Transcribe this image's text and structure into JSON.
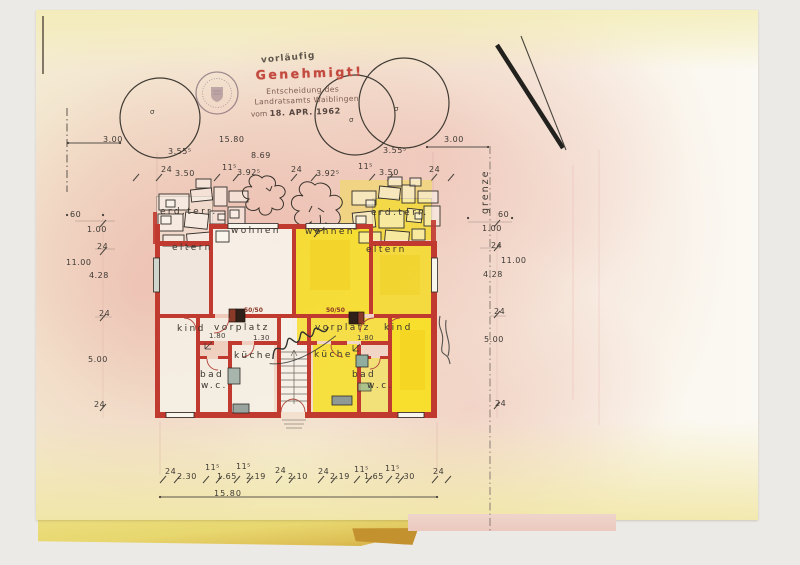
{
  "stamp": {
    "pre": "vorläufig",
    "title": "Genehmigt!",
    "line2": "Entscheidung des",
    "line3": "Landratsamts Waiblingen",
    "line4_prefix": "vom",
    "date": "18. APR. 1962"
  },
  "boundary": {
    "grenze": "grenze"
  },
  "trees": {
    "marks": [
      {
        "text": "σ",
        "x": 150,
        "y": 109
      },
      {
        "text": "σ",
        "x": 349,
        "y": 117
      },
      {
        "text": "σ",
        "x": 394,
        "y": 106
      }
    ]
  },
  "dims": {
    "row_overall": [
      {
        "text": "3.00",
        "x": 103,
        "y": 136
      },
      {
        "text": "15.80",
        "x": 219,
        "y": 136
      },
      {
        "text": "3.00",
        "x": 444,
        "y": 136
      }
    ],
    "row_house": [
      {
        "text": "3.55⁵",
        "x": 168,
        "y": 148
      },
      {
        "text": "8.69",
        "x": 251,
        "y": 152
      },
      {
        "text": "3.55⁵",
        "x": 383,
        "y": 147
      }
    ],
    "row_rooms_top": [
      {
        "text": "24",
        "x": 161,
        "y": 166
      },
      {
        "text": "3.50",
        "x": 175,
        "y": 170
      },
      {
        "text": "11⁵",
        "x": 222,
        "y": 164
      },
      {
        "text": "3.92⁵",
        "x": 237,
        "y": 169
      },
      {
        "text": "24",
        "x": 291,
        "y": 166
      },
      {
        "text": "3.92⁵",
        "x": 316,
        "y": 170
      },
      {
        "text": "11⁵",
        "x": 358,
        "y": 163
      },
      {
        "text": "3.50",
        "x": 379,
        "y": 169
      },
      {
        "text": "24",
        "x": 429,
        "y": 166
      }
    ],
    "col_left": [
      {
        "text": "60",
        "x": 70,
        "y": 211
      },
      {
        "text": "1.00",
        "x": 87,
        "y": 226
      },
      {
        "text": "24",
        "x": 97,
        "y": 243
      },
      {
        "text": "11.00",
        "x": 66,
        "y": 259
      },
      {
        "text": "4.28",
        "x": 89,
        "y": 272
      },
      {
        "text": "24",
        "x": 99,
        "y": 310
      },
      {
        "text": "5.00",
        "x": 88,
        "y": 356
      },
      {
        "text": "24",
        "x": 94,
        "y": 401
      }
    ],
    "col_right": [
      {
        "text": "60",
        "x": 498,
        "y": 211
      },
      {
        "text": "1.00",
        "x": 482,
        "y": 225
      },
      {
        "text": "24",
        "x": 491,
        "y": 242
      },
      {
        "text": "11.00",
        "x": 501,
        "y": 257
      },
      {
        "text": "4.28",
        "x": 483,
        "y": 271
      },
      {
        "text": "24",
        "x": 494,
        "y": 308
      },
      {
        "text": "5.00",
        "x": 484,
        "y": 336
      },
      {
        "text": "24",
        "x": 495,
        "y": 400
      }
    ],
    "row_bottom": [
      {
        "text": "24",
        "x": 165,
        "y": 468
      },
      {
        "text": "2.30",
        "x": 177,
        "y": 473
      },
      {
        "text": "11⁵",
        "x": 205,
        "y": 464
      },
      {
        "text": "1.65",
        "x": 217,
        "y": 473
      },
      {
        "text": "11⁵",
        "x": 236,
        "y": 463
      },
      {
        "text": "2.19",
        "x": 246,
        "y": 473
      },
      {
        "text": "24",
        "x": 275,
        "y": 467
      },
      {
        "text": "2.10",
        "x": 288,
        "y": 473
      },
      {
        "text": "24",
        "x": 318,
        "y": 468
      },
      {
        "text": "2.19",
        "x": 330,
        "y": 473
      },
      {
        "text": "11⁵",
        "x": 354,
        "y": 466
      },
      {
        "text": "1.65",
        "x": 364,
        "y": 473
      },
      {
        "text": "11⁵",
        "x": 385,
        "y": 465
      },
      {
        "text": "2.30",
        "x": 395,
        "y": 473
      },
      {
        "text": "24",
        "x": 433,
        "y": 468
      }
    ],
    "bottom_total": {
      "text": "15.80"
    }
  },
  "rooms": [
    {
      "text": "erd.terr.",
      "x": 160,
      "y": 208
    },
    {
      "text": "wohnen",
      "x": 231,
      "y": 227
    },
    {
      "text": "eltern",
      "x": 172,
      "y": 244
    },
    {
      "text": "wohnen",
      "x": 305,
      "y": 228
    },
    {
      "text": "erd.terr.",
      "x": 371,
      "y": 209
    },
    {
      "text": "eltern",
      "x": 366,
      "y": 246
    },
    {
      "text": "kind",
      "x": 177,
      "y": 325
    },
    {
      "text": "vorplatz",
      "x": 214,
      "y": 324
    },
    {
      "text": "küche",
      "x": 234,
      "y": 352
    },
    {
      "text": "bad",
      "x": 200,
      "y": 371
    },
    {
      "text": "w.c.",
      "x": 201,
      "y": 382
    },
    {
      "text": "vorplatz",
      "x": 315,
      "y": 324
    },
    {
      "text": "kind",
      "x": 384,
      "y": 324
    },
    {
      "text": "küche",
      "x": 314,
      "y": 351
    },
    {
      "text": "bad",
      "x": 352,
      "y": 371
    },
    {
      "text": "w.c.",
      "x": 367,
      "y": 382
    }
  ],
  "inner_dims": [
    {
      "text": "1.80",
      "x": 209,
      "y": 333
    },
    {
      "text": "1.30",
      "x": 253,
      "y": 335
    },
    {
      "text": "1.80",
      "x": 357,
      "y": 335
    }
  ],
  "chimney_labels": [
    {
      "text": "50/50",
      "x": 244,
      "y": 308
    },
    {
      "text": "50/50",
      "x": 326,
      "y": 308
    }
  ],
  "colors": {
    "wall_red": "#c13a30",
    "highlight_yellow": "#f6dd2b",
    "stamp_red": "#c24a3e",
    "page_pink": "#eec9c3",
    "page_yellow": "#f3ecb4"
  }
}
